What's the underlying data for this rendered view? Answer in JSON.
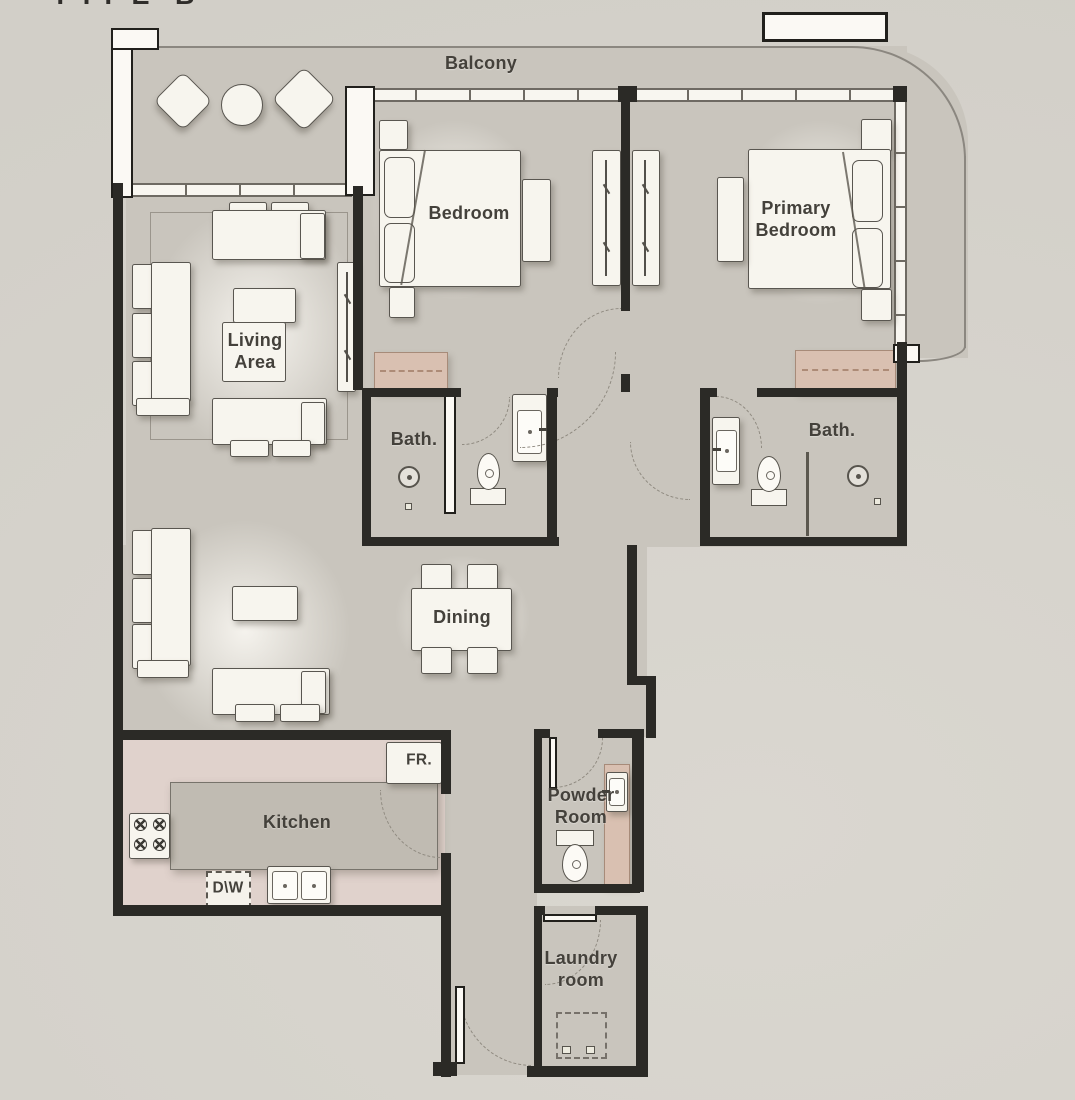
{
  "title_partial": "TYPE B",
  "palette": {
    "background": "#d7d4cd",
    "floor": "#c9c5bd",
    "kitchen_floor": "#e0d2cc",
    "counter": "#c0bbb2",
    "wall": "#2b2a26",
    "furniture": "#f7f5ee",
    "wardrobe_accent": "#d9c0b1",
    "label_text": "#44413b"
  },
  "rooms": {
    "balcony": {
      "label": "Balcony"
    },
    "bedroom": {
      "label": "Bedroom"
    },
    "primary_bedroom": {
      "label": "Primary\nBedroom"
    },
    "living_area": {
      "label": "Living\nArea"
    },
    "bath_1": {
      "label": "Bath."
    },
    "bath_2": {
      "label": "Bath."
    },
    "dining": {
      "label": "Dining"
    },
    "kitchen": {
      "label": "Kitchen"
    },
    "powder_room": {
      "label": "Powder\nRoom"
    },
    "laundry_room": {
      "label": "Laundry\nroom"
    }
  },
  "appliances": {
    "fridge": "FR.",
    "dishwasher": "D\\W"
  }
}
